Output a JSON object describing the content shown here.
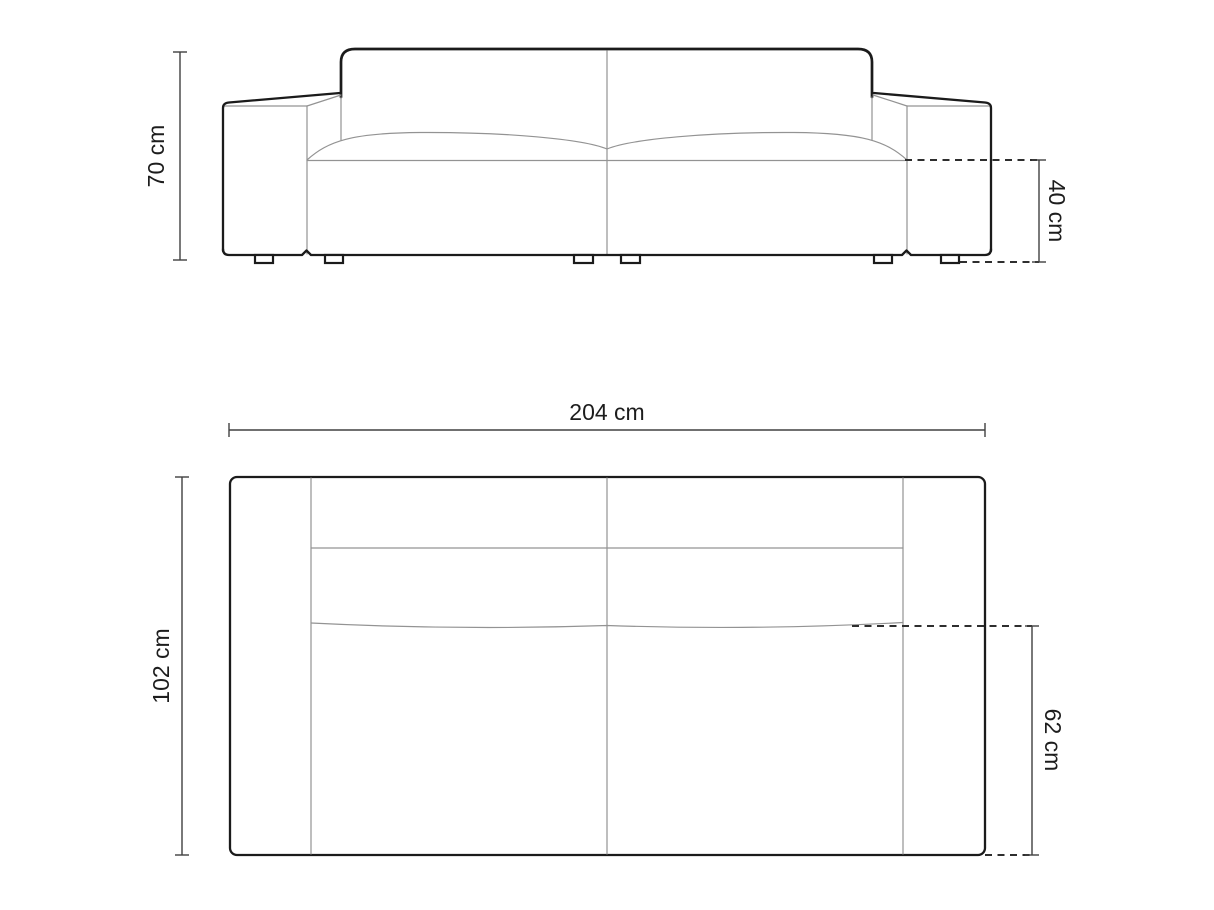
{
  "colors": {
    "background": "#ffffff",
    "outline": "#1b1b1b",
    "thin_line": "#939393",
    "dashed_line": "#2e2e2e",
    "dimension_line": "#404040",
    "label_text": "#1d1d1d"
  },
  "dimensions": {
    "height": {
      "label": "70 cm",
      "value": 70,
      "unit": "cm"
    },
    "seat_height": {
      "label": "40 cm",
      "value": 40,
      "unit": "cm"
    },
    "width": {
      "label": "204 cm",
      "value": 204,
      "unit": "cm"
    },
    "depth": {
      "label": "102 cm",
      "value": 102,
      "unit": "cm"
    },
    "seat_depth": {
      "label": "62 cm",
      "value": 62,
      "unit": "cm"
    }
  }
}
